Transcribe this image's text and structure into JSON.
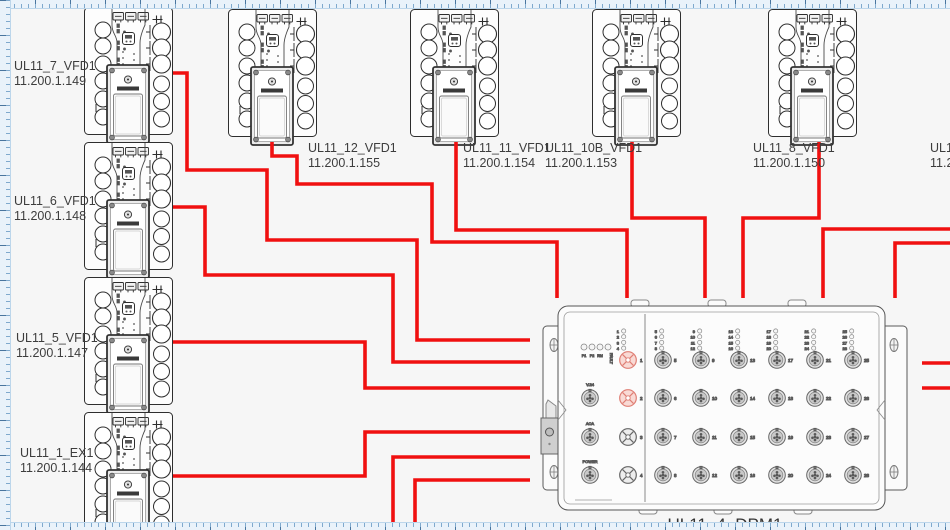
{
  "colors": {
    "cable": "#f01010",
    "outline": "#2e2e2e",
    "port_fill": "#e3e3e3",
    "port_inner": "#c9c9c9",
    "port_red_stroke": "#df7e74",
    "port_red_fill": "#f9dad5",
    "ruler_bg": "#e9f2fa",
    "ruler_tick": "#7fa9cd"
  },
  "devices": [
    {
      "name": "UL11_7_VFD1",
      "ip": "11.200.1.149"
    },
    {
      "name": "UL11_6_VFD1",
      "ip": "11.200.1.148"
    },
    {
      "name": "UL11_5_VFD1",
      "ip": "11.200.1.147"
    },
    {
      "name": "UL11_1_EX1",
      "ip": "11.200.1.144"
    },
    {
      "name": "UL11_12_VFD1",
      "ip": "11.200.1.155"
    },
    {
      "name": "UL11_11_VFD1",
      "ip": "11.200.1.154"
    },
    {
      "name": "UL11_10B_VFD1",
      "ip": "11.200.1.153"
    },
    {
      "name": "UL11_8_VFD1",
      "ip": "11.200.1.150"
    },
    {
      "name": "UL11",
      "ip": "11.2"
    }
  ],
  "dpm": {
    "name": "UL11_4_DPM1",
    "status_leds": [
      "P1",
      "P2",
      "RM",
      "FAULT"
    ],
    "aux_ports": [
      "V.24",
      "ACA",
      "POWER"
    ],
    "left_ports": [
      "1",
      "2",
      "3",
      "4"
    ],
    "highlighted_ports": [
      "1",
      "2"
    ],
    "grid_port_columns": [
      [
        "5",
        "6",
        "7",
        "8"
      ],
      [
        "9",
        "10",
        "11",
        "12"
      ],
      [
        "13",
        "14",
        "15",
        "16"
      ],
      [
        "17",
        "18",
        "19",
        "20"
      ],
      [
        "21",
        "22",
        "23",
        "24"
      ],
      [
        "25",
        "26",
        "27",
        "28"
      ]
    ]
  },
  "cables": [
    {
      "id": "c1",
      "points": [
        [
          173,
          73
        ],
        [
          187,
          73
        ],
        [
          187,
          170
        ],
        [
          267,
          170
        ],
        [
          267,
          240
        ],
        [
          417,
          240
        ],
        [
          417,
          340
        ],
        [
          530,
          340
        ]
      ]
    },
    {
      "id": "c2",
      "points": [
        [
          173,
          207
        ],
        [
          205,
          207
        ],
        [
          205,
          275
        ],
        [
          393,
          275
        ],
        [
          393,
          362
        ],
        [
          530,
          362
        ]
      ]
    },
    {
      "id": "c3",
      "points": [
        [
          272,
          142
        ],
        [
          272,
          156
        ],
        [
          297,
          156
        ],
        [
          297,
          184
        ],
        [
          432,
          184
        ],
        [
          432,
          242
        ],
        [
          557,
          242
        ],
        [
          557,
          298
        ]
      ]
    },
    {
      "id": "c4",
      "points": [
        [
          456,
          142
        ],
        [
          456,
          230
        ],
        [
          627,
          230
        ],
        [
          627,
          298
        ]
      ]
    },
    {
      "id": "c5",
      "points": [
        [
          632,
          142
        ],
        [
          632,
          218
        ],
        [
          705,
          218
        ],
        [
          705,
          298
        ]
      ]
    },
    {
      "id": "c6",
      "points": [
        [
          819,
          142
        ],
        [
          819,
          218
        ],
        [
          743,
          218
        ],
        [
          743,
          298
        ]
      ]
    },
    {
      "id": "c7",
      "points": [
        [
          950,
          229
        ],
        [
          823,
          229
        ],
        [
          823,
          298
        ]
      ]
    },
    {
      "id": "c8",
      "points": [
        [
          950,
          243
        ],
        [
          895,
          243
        ],
        [
          895,
          298
        ]
      ]
    },
    {
      "id": "c9",
      "points": [
        [
          173,
          342
        ],
        [
          365,
          342
        ],
        [
          365,
          388
        ],
        [
          530,
          388
        ]
      ]
    },
    {
      "id": "c10",
      "points": [
        [
          173,
          476
        ],
        [
          365,
          476
        ],
        [
          365,
          432
        ],
        [
          530,
          432
        ]
      ]
    },
    {
      "id": "c11",
      "points": [
        [
          393,
          532
        ],
        [
          393,
          457
        ],
        [
          530,
          457
        ]
      ]
    },
    {
      "id": "c12",
      "points": [
        [
          415,
          532
        ],
        [
          415,
          480
        ],
        [
          530,
          480
        ]
      ]
    },
    {
      "id": "c13",
      "points": [
        [
          922,
          363
        ],
        [
          950,
          363
        ]
      ]
    },
    {
      "id": "c14",
      "points": [
        [
          922,
          388
        ],
        [
          950,
          388
        ]
      ]
    }
  ]
}
